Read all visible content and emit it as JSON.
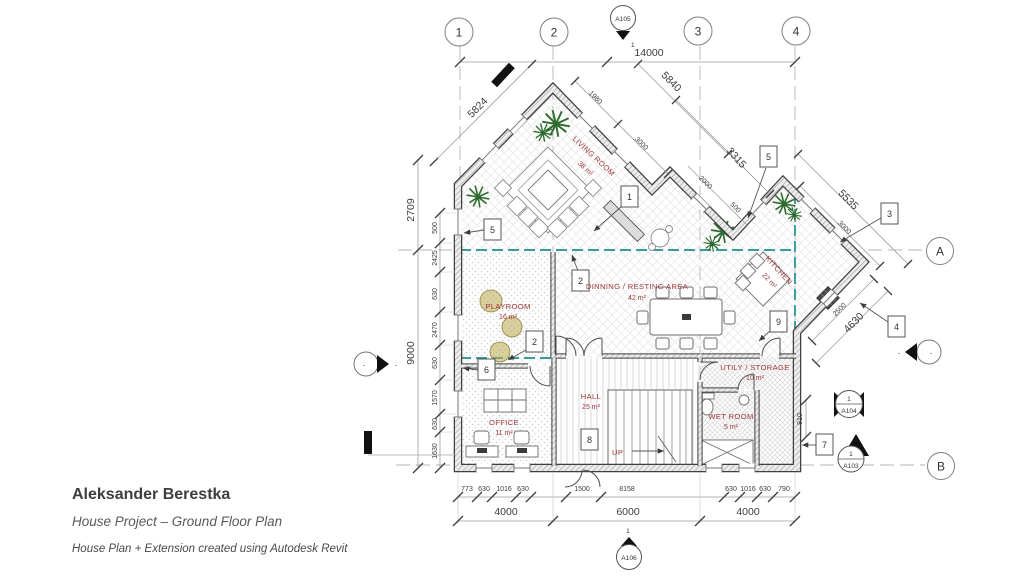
{
  "title_block": {
    "author": "Aleksander Berestka",
    "project": "House Project – Ground Floor Plan",
    "note": "House Plan + Extension created using Autodesk Revit"
  },
  "grid": {
    "cols": [
      "1",
      "2",
      "3",
      "4"
    ],
    "rows": [
      "A",
      "B"
    ]
  },
  "view_markers": {
    "a105": {
      "sheet": "A105",
      "detail": "1"
    },
    "a106": {
      "sheet": "A106",
      "detail": "1"
    },
    "a104": {
      "sheet": "A104",
      "detail": "1"
    },
    "a103": {
      "sheet": "A103",
      "detail": "1"
    }
  },
  "elevation_dash": "-",
  "rooms": {
    "living": {
      "name": "LIVING ROOM",
      "area": "38 m²"
    },
    "kitchen": {
      "name": "KITCHEN",
      "area": "22 m²"
    },
    "dining": {
      "name": "DINNING / RESTING AREA",
      "area": "42 m²"
    },
    "playroom": {
      "name": "PLAYROOM",
      "area": "16 m²"
    },
    "hall": {
      "name": "HALL",
      "area": "25 m²"
    },
    "office": {
      "name": "OFFICE",
      "area": "11 m²"
    },
    "wet": {
      "name": "WET ROOM",
      "area": "5 m²"
    },
    "utility": {
      "name": "UTILY / STORAGE",
      "area": "10 m²"
    }
  },
  "stairs": {
    "direction": "UP"
  },
  "tags": {
    "t1": "1",
    "t2_dining": "2",
    "t2_playroom": "2",
    "t3": "3",
    "t4": "4",
    "t5_left": "5",
    "t5_right": "5",
    "t6": "6",
    "t7": "7",
    "t8": "8",
    "t9": "9"
  },
  "dims": {
    "top_total": "14000",
    "diag_left": "5824",
    "diag_right": "5840",
    "diag_right_segs": [
      "1980",
      "3000"
    ],
    "upper_right": [
      "3315",
      "2000",
      "500"
    ],
    "right_upper": [
      "5535",
      "3000"
    ],
    "right_lower": [
      "4630",
      "2500"
    ],
    "right_side": "910",
    "left_upper": "2709",
    "left_total": "9000",
    "left_segs": [
      "500",
      "2425",
      "630",
      "2470",
      "630",
      "1570",
      "630",
      "1630"
    ],
    "bottom_segs": [
      "773",
      "630",
      "1016",
      "630",
      "1500",
      "8158",
      "630",
      "1016",
      "630",
      "790"
    ],
    "bottom_major": [
      "4000",
      "6000",
      "4000"
    ]
  },
  "colors": {
    "match_line_teal": "#1e8f8f",
    "room_label_red": "#9e3434",
    "line_gray": "#3c3c3c"
  }
}
